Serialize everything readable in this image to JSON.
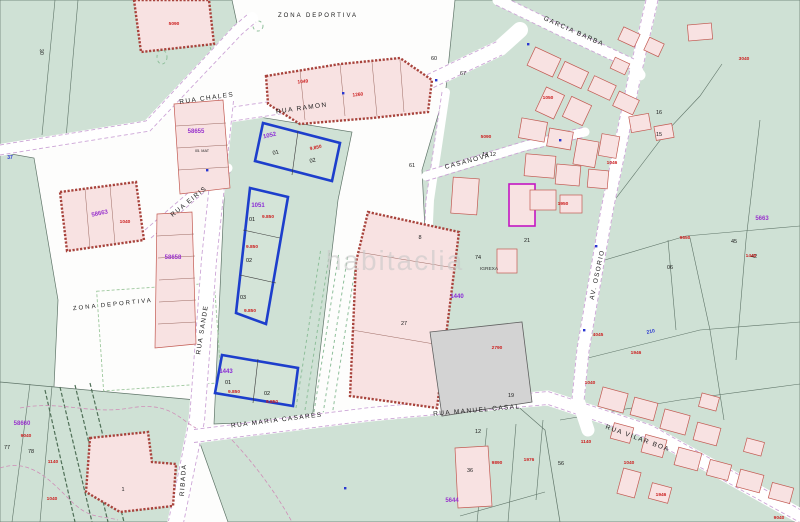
{
  "watermark": "habitaclia",
  "colors": {
    "green_zone": "#cfe1d5",
    "building_pink": "#f8e2e2",
    "hatch_red": "#a8433c",
    "parcel_blue": "#1d3ecc",
    "road_edge_lilac": "#c9a0d4",
    "area_red": "#cc2020",
    "id_purple": "#9933cc",
    "text_blue": "#2936d0",
    "gray_parcel": "#d3d3d3"
  },
  "zone_labels": [
    "ZONA DEPORTIVA",
    "ZONA DEPORTIVA"
  ],
  "streets": [
    "RUA CHALES",
    "RUA RAMON",
    "RUA EIRIS",
    "RUA MARIA CASARES",
    "RUA MANUEL CASAL",
    "RUA VILAR BOA",
    "GARCIA BARBA",
    "RUA SANDE",
    "AV. OSORIO",
    "RIBADA",
    "CASANOVA"
  ],
  "cadastral_ids": [
    "58655",
    "58658",
    "58663",
    "58660",
    "5663",
    "5644"
  ],
  "parcel_ids": [
    "1052",
    "1051",
    "1443",
    "1440"
  ],
  "unit": {
    "n1": "01",
    "n2": "02",
    "n3": "03"
  },
  "numbers": [
    "30",
    "27",
    "8",
    "74",
    "06",
    "45",
    "42",
    "16",
    "15",
    "77",
    "78",
    "36",
    "56",
    "12",
    "19",
    "21",
    "14 12",
    "60",
    "67",
    "61",
    "1"
  ],
  "areas": [
    "9.850",
    "9.850",
    "9.850",
    "9.850",
    "9.850",
    "9.850",
    "1049",
    "1260",
    "5090",
    "9650",
    "1440",
    "4045",
    "1946",
    "1040",
    "9890",
    "1976",
    "1140",
    "9040",
    "1140",
    "1040",
    "1040",
    "2790",
    "1050",
    "3040",
    "1950",
    "1046",
    "1040",
    "1946",
    "9040",
    "5090"
  ],
  "blue_marks": [
    "210",
    "37"
  ],
  "place_labels": [
    "IGREXA"
  ],
  "small_text": [
    "05. MAT"
  ]
}
